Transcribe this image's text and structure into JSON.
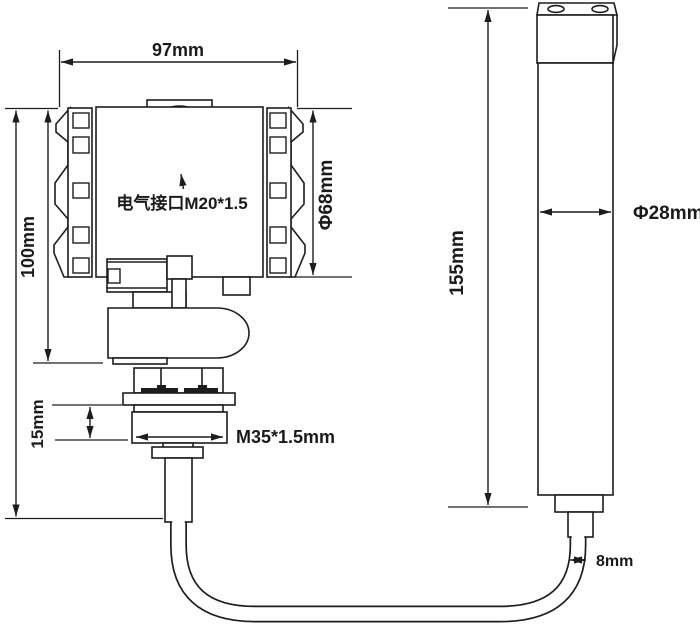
{
  "colors": {
    "background": "#ffffff",
    "line": "#1d1d1d",
    "text": "#1a1a1a"
  },
  "diagram": {
    "type": "engineering-dimension-drawing",
    "transmitter": {
      "width_label": "97mm",
      "height_label": "100mm",
      "cover_diameter_label": "Φ68mm",
      "conduit_label": "电气接口M20*1.5",
      "thread_length_label": "15mm",
      "thread_spec_label": "M35*1.5mm"
    },
    "probe": {
      "length_label": "155mm",
      "diameter_label": "Φ28mm",
      "cable_diameter_label": "8mm"
    }
  }
}
